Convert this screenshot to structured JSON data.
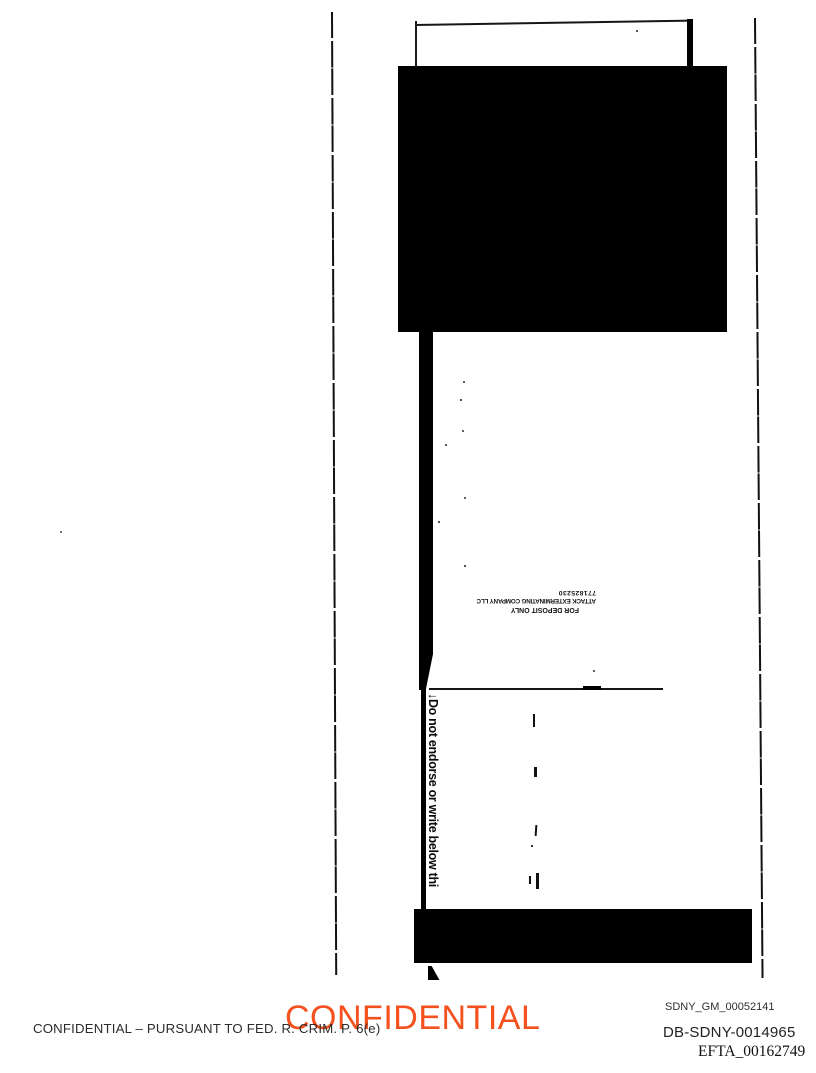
{
  "scan": {
    "endorsement_warning": "↓Do not endorse or write below thi",
    "deposit_stamp": {
      "line1": "FOR DEPOSIT ONLY",
      "line2": "ATTACK EXTERMINATING COMPANY LLC",
      "line3": "771825230"
    }
  },
  "footer": {
    "watermark": "CONFIDENTIAL",
    "watermark_color": "#f4511e",
    "legend": "CONFIDENTIAL – PURSUANT TO FED. R. CRIM. P. 6(e)",
    "bates_numbers": [
      "SDNY_GM_00052141",
      "DB-SDNY-0014965",
      "EFTA_00162749"
    ]
  }
}
